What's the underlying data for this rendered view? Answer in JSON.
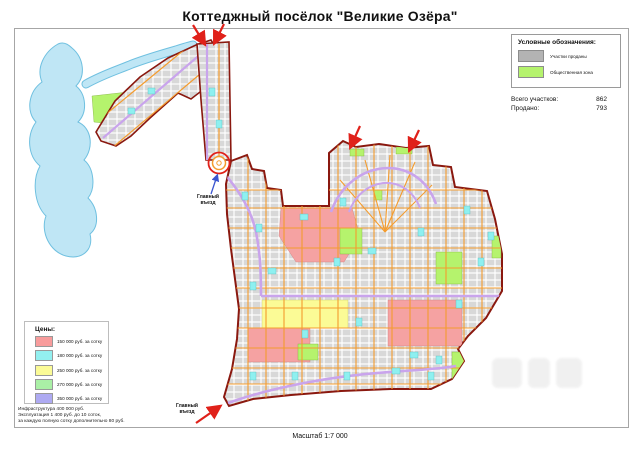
{
  "page": {
    "title": "Коттеджный посёлок \"Великие Озёра\"",
    "scale_label": "Масштаб 1:7 000"
  },
  "legend": {
    "title": "Условные обозначения:",
    "items": [
      {
        "label": "Участки проданы",
        "color": "#b3b3b3"
      },
      {
        "label": "Общественная зона",
        "color": "#b5f36d"
      }
    ]
  },
  "stats": {
    "total_label": "Всего участков:",
    "total_value": "862",
    "sold_label": "Продано:",
    "sold_value": "793"
  },
  "prices": {
    "title": "Цены:",
    "items": [
      {
        "label": "150 000 руб. за сотку",
        "color": "#f89c9c"
      },
      {
        "label": "180 000 руб. за сотку",
        "color": "#93f0f0"
      },
      {
        "label": "250 000 руб. за сотку",
        "color": "#fbfb96"
      },
      {
        "label": "270 000 руб. за сотку",
        "color": "#aaf0a6"
      },
      {
        "label": "350 000 руб. за сотку",
        "color": "#aeaaf2"
      }
    ]
  },
  "notes": {
    "line1": "Инфраструктура 400 000 руб.",
    "line2": "Эксплуатация 1 400 руб. до 10 соток,",
    "line3": "за каждую полную сотку дополнительно 80 руб."
  },
  "map": {
    "entrance_top": "Главный въезд",
    "entrance_bottom": "Главный въезд",
    "colors": {
      "water": "#bfe6f5",
      "water_edge": "#6fc0e0",
      "boundary": "#8a180f",
      "road_orange": "#f49c2e",
      "road_purple": "#c9a4ec",
      "parcel": "#d8d8d8",
      "public_green": "#b5f36d",
      "zone_pink": "#f5a2a2",
      "zone_yellow": "#fbfb96",
      "zone_cyan": "#8ef0f0",
      "arrow_red": "#e0211a",
      "arrow_blue": "#3a55d0"
    }
  }
}
